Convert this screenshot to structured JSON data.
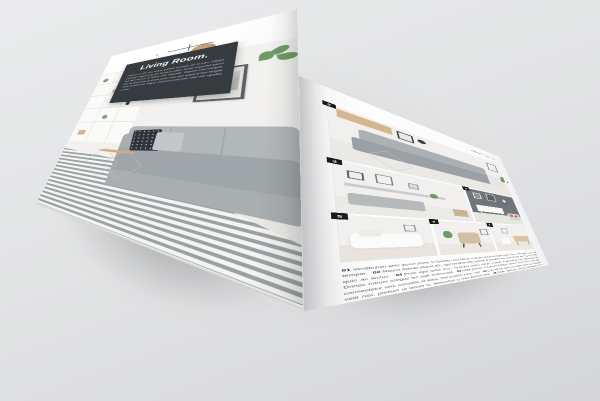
{
  "scene": {
    "description": "open interior-design magazine spread mockup on gray surface"
  },
  "colors": {
    "background": "#e2e3e4",
    "page": "#fcfcfc",
    "intro_panel": "#363b40",
    "badge": "#17191b",
    "accent_green": "#6f9c66",
    "sofa_gray": "#9fa5a8"
  },
  "left_page": {
    "title": "Living Room.",
    "intro": "Vivamus ut enim nec massa porttitor posuere vel at odio. Integer sollicitudin magna quis nibh tincidunt mattis. Donec imperdiet ipsum sed velit rhoncus, at dictum nibh vulputate. Aliquam erat volutpat. Sed tincidunt lectus at ornare porta. Duis eget augue id felis fringilla luctus sit amet non magna. Praesent porta justo vitae nisl egestas cursus.",
    "photo_scene": "living-room-gray-sofa-striped-rug"
  },
  "right_page": {
    "corner_label": "PRODUCT CATALOG",
    "photos": [
      {
        "badge": "2",
        "scene": "gray-sectional-sofa-living-room"
      },
      {
        "badge": "3",
        "scene": "white-living-room-with-bench"
      },
      {
        "badge": "4",
        "scene": "dark-wall-sideboard-room"
      },
      {
        "badge": "5",
        "scene": "bright-white-sofa-room"
      },
      {
        "badge": "6",
        "scene": "beige-lounge-chair-room"
      },
      {
        "badge": "7",
        "scene": "white-room-wood-desk"
      }
    ],
    "caption": {
      "segments": [
        {
          "num": "01",
          "text": "Vestibulum ante ipsum primis in faucibus orci luctus et ultrices posuere cubilia curae; donec velit neque, auctor sed tempor."
        },
        {
          "num": "02",
          "text": "Mauris blandit aliquet elit, eget tincidunt nibh pulvinar a. Curabitur non nulla sit amet nisl tempus convallis quis ac lectus."
        },
        {
          "num": "03",
          "text": "Proin eget tortor risus. Praesent sapien massa, convallis a pellentesque nec, egestas non nisi. Donec rutrum congue leo eget malesuada."
        },
        {
          "num": "04",
          "text": "Nulla porttitor accumsan tincidunt. Vivamus magna justo, lacinia eget consectetur sed, convallis at tellus. Sed porttitor lectus nibh."
        },
        {
          "num": "05",
          "text": "Cras ultricies ligula sed magna dictum porta. Quisque velit nisi, pretium ut lacinia in, elementum id enim suscipit tortor."
        },
        {
          "num": "06",
          "text": "Donec sollicitudin molestie malesuada. Lorem ipsum dolor sit amet, consectetur adipiscing elit. Curabitur arcu erat, accumsan id imperdiet et."
        },
        {
          "num": "07",
          "text": "Pellentesque in ipsum id orci porta dapibus. Vivamus suscipit tortor eget felis porttitor volutpat quisque velit nisi pretium."
        }
      ]
    }
  }
}
